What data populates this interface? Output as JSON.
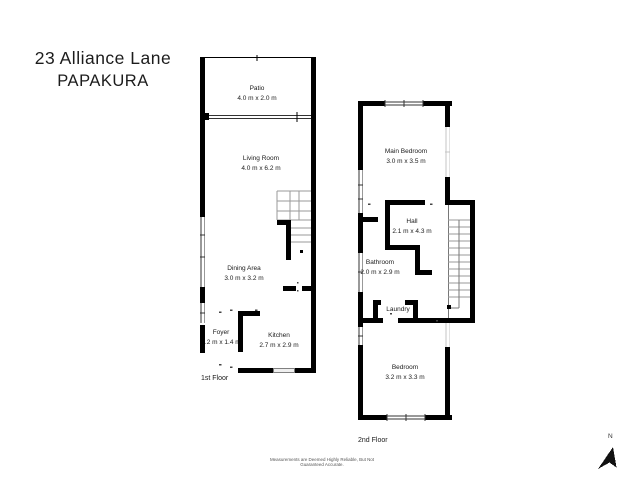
{
  "title": {
    "address": "23 Alliance Lane",
    "city": "PAPAKURA"
  },
  "floors": [
    {
      "label": "1st Floor",
      "rooms": [
        {
          "name": "Patio",
          "dims": "4.0 m x 2.0 m"
        },
        {
          "name": "Living Room",
          "dims": "4.0 m x 6.2 m"
        },
        {
          "name": "Dining Area",
          "dims": "3.0 m x 3.2 m"
        },
        {
          "name": "Foyer",
          "dims": "1.2 m x 1.4 m"
        },
        {
          "name": "Kitchen",
          "dims": "2.7 m x 2.9 m"
        }
      ]
    },
    {
      "label": "2nd Floor",
      "rooms": [
        {
          "name": "Main Bedroom",
          "dims": "3.0 m x 3.5 m"
        },
        {
          "name": "Hall",
          "dims": "2.1 m x 4.3 m"
        },
        {
          "name": "Bathroom",
          "dims": "2.0 m x 2.9 m"
        },
        {
          "name": "Laundry",
          "dims": ""
        },
        {
          "name": "Bedroom",
          "dims": "3.2 m x 3.3 m"
        }
      ]
    }
  ],
  "compass": {
    "label": "N"
  },
  "disclaimer": "Measurements are Deemed Highly Reliable, But Not Guaranteed Accurate.",
  "colors": {
    "wall": "#000000",
    "stair_line": "#9a9a9a",
    "window_line": "#333333"
  }
}
